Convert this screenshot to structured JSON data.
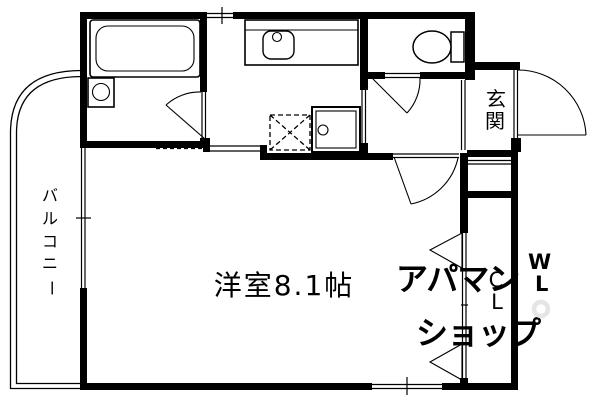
{
  "floor_plan": {
    "colors": {
      "background": "#ffffff",
      "line": "#000000",
      "watermark": "#e5e5e5"
    },
    "rooms": {
      "main_room": {
        "label": "洋室8.1帖"
      },
      "balcony": {
        "label": "バルコニー",
        "chars": [
          "バ",
          "ル",
          "コ",
          "ニ",
          "ー"
        ]
      },
      "entrance": {
        "label": "玄関",
        "chars": [
          "玄",
          "関"
        ]
      },
      "closet": {
        "label": "CL",
        "chars": [
          "C",
          "L"
        ]
      }
    },
    "fixtures": [
      "bathtub",
      "washing-machine-pan",
      "kitchen-counter",
      "kitchen-sink",
      "refrigerator-space",
      "washing-machine-space",
      "toilet",
      "entrance-door",
      "bathroom-door",
      "toilet-door",
      "main-room-door",
      "closet-bifold-doors",
      "balcony-sliding-window",
      "top-window",
      "bottom-window"
    ],
    "watermark": {
      "line1": "アパマン",
      "line2": "ショップ",
      "mark_w": "W",
      "mark_l": "L"
    }
  }
}
